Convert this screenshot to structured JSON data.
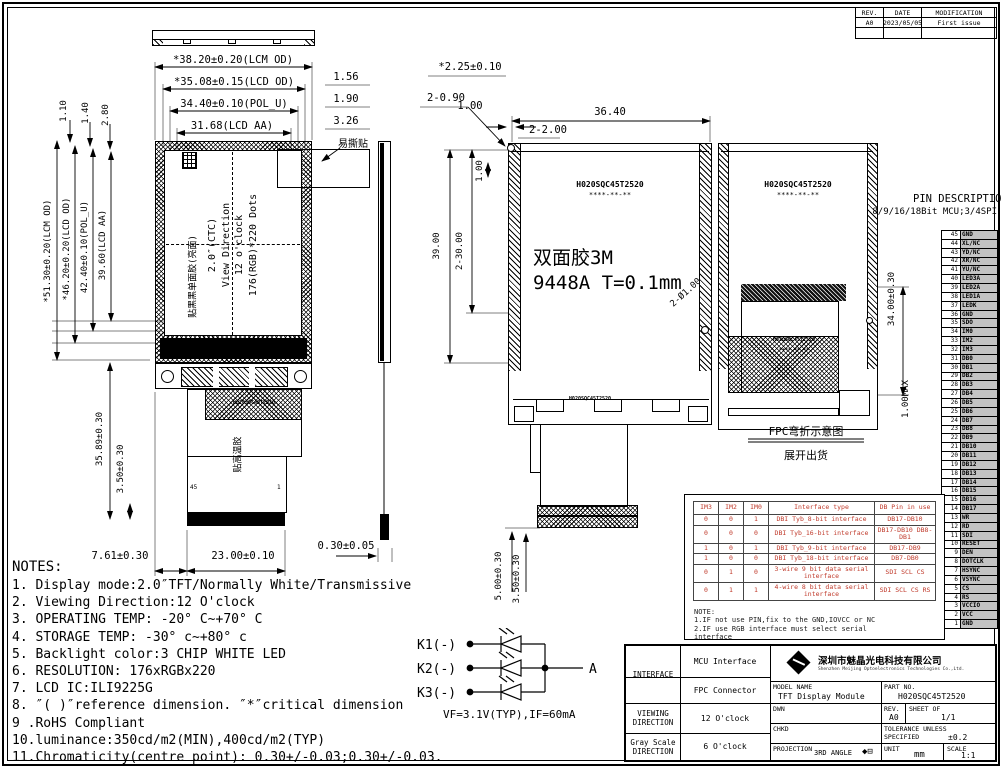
{
  "sheet": {
    "rev_header": "REV.",
    "date_header": "DATE",
    "mod_header": "MODIFICATION",
    "rev_value": "A0",
    "date_value": "2023/05/05",
    "mod_value": "First issue"
  },
  "left_view": {
    "dims": {
      "lcm_w": "*38.20±0.20(LCM OD)",
      "lcd_w": "*35.08±0.15(LCD OD)",
      "pol_w": "34.40±0.10(POL_U)",
      "aa_w": "31.68(LCD AA)",
      "off1": "1.56",
      "off2": "1.90",
      "off3": "3.26",
      "t1": "1.10",
      "t2": "1.40",
      "t3": "2.80",
      "lcm_h": "*51.30±0.20(LCM OD)",
      "lcd_h": "*46.20±0.20(LCD OD)",
      "pol_h": "42.40±0.10(POL_U)",
      "aa_h": "39.60(LCD AA)",
      "fpc_h": "35.89±0.30",
      "conn_h": "3.50±0.30",
      "fpc_x": "7.61±0.30",
      "conn_w": "23.00±0.10",
      "thick": "0.30±0.05"
    },
    "screen": {
      "line1": "2.0″(CTC)",
      "line2": "View Direction",
      "line3": "12 o'clock",
      "line4": "176(RGB)*220 Dots"
    },
    "labels": {
      "tear": "易撕贴",
      "black_tape": "贴黑黑单面胶(亮面)",
      "ht_tape": "贴高温胶"
    },
    "fpc_marking": "H020SQC45T2520",
    "pin_left": "45",
    "pin_right": "1"
  },
  "middle_view": {
    "dims": {
      "d1": "*2.25±0.10",
      "d2": "2-0.90",
      "d3": "1.00",
      "d4": "36.40",
      "d5": "2-2.00",
      "v1": "39.00",
      "v2": "2-30.00",
      "v3": "1.00",
      "hole": "2-Ø1.00",
      "b1": "5.00±0.30",
      "b2": "3.50±0.30"
    },
    "marking1": "H020SQC45T2520",
    "marking2": "****-**-**",
    "tape1": "双面胶3M",
    "tape2": "9448A T=0.1mm",
    "fpc_marking": "H020SQC45T2520"
  },
  "right_view": {
    "marking1": "H020SQC45T2520",
    "marking2": "****-**-**",
    "fpc_marking1": "H020SQC45T2520",
    "fpc_marking2": "****-**-**",
    "dims": {
      "h": "34.00±0.30",
      "max": "1.00MAX"
    },
    "caption1": "FPC弯折示意图",
    "caption2": "展开出货"
  },
  "pin_desc": {
    "title": "PIN DESCRIPTION",
    "subtitle": "8/9/16/18Bit MCU;3/4SPI",
    "pins": [
      {
        "n": "45",
        "v": "GND"
      },
      {
        "n": "44",
        "v": "XL/NC"
      },
      {
        "n": "43",
        "v": "YD/NC"
      },
      {
        "n": "42",
        "v": "XR/NC"
      },
      {
        "n": "41",
        "v": "YU/NC"
      },
      {
        "n": "40",
        "v": "LED3A"
      },
      {
        "n": "39",
        "v": "LED2A"
      },
      {
        "n": "38",
        "v": "LED1A"
      },
      {
        "n": "37",
        "v": "LEDK"
      },
      {
        "n": "36",
        "v": "GND"
      },
      {
        "n": "35",
        "v": "SDO"
      },
      {
        "n": "34",
        "v": "IM0"
      },
      {
        "n": "33",
        "v": "IM2"
      },
      {
        "n": "32",
        "v": "IM3"
      },
      {
        "n": "31",
        "v": "DB0"
      },
      {
        "n": "30",
        "v": "DB1"
      },
      {
        "n": "29",
        "v": "DB2"
      },
      {
        "n": "28",
        "v": "DB3"
      },
      {
        "n": "27",
        "v": "DB4"
      },
      {
        "n": "26",
        "v": "DB5"
      },
      {
        "n": "25",
        "v": "DB6"
      },
      {
        "n": "24",
        "v": "DB7"
      },
      {
        "n": "23",
        "v": "DB8"
      },
      {
        "n": "22",
        "v": "DB9"
      },
      {
        "n": "21",
        "v": "DB10"
      },
      {
        "n": "20",
        "v": "DB11"
      },
      {
        "n": "19",
        "v": "DB12"
      },
      {
        "n": "18",
        "v": "DB13"
      },
      {
        "n": "17",
        "v": "DB14"
      },
      {
        "n": "16",
        "v": "DB15"
      },
      {
        "n": "15",
        "v": "DB16"
      },
      {
        "n": "14",
        "v": "DB17"
      },
      {
        "n": "13",
        "v": "WR"
      },
      {
        "n": "12",
        "v": "RD"
      },
      {
        "n": "11",
        "v": "SDI"
      },
      {
        "n": "10",
        "v": "RESET"
      },
      {
        "n": "9",
        "v": "DEN"
      },
      {
        "n": "8",
        "v": "DOTCLK"
      },
      {
        "n": "7",
        "v": "HSYNC"
      },
      {
        "n": "6",
        "v": "VSYNC"
      },
      {
        "n": "5",
        "v": "CS"
      },
      {
        "n": "4",
        "v": "RS"
      },
      {
        "n": "3",
        "v": "VCCIO"
      },
      {
        "n": "2",
        "v": "VCC"
      },
      {
        "n": "1",
        "v": "GND"
      }
    ]
  },
  "interface_table": {
    "headers": {
      "im3": "IM3",
      "im2": "IM2",
      "im0": "IM0",
      "type": "Interface type",
      "db": "DB Pin in use"
    },
    "rows": [
      {
        "a": "0",
        "b": "0",
        "c": "1",
        "t": "DBI Tyb_8-bit interface",
        "d": "DB17-DB10"
      },
      {
        "a": "0",
        "b": "0",
        "c": "0",
        "t": "DBI Tyb_16-bit interface",
        "d": "DB17-DB10 DB8-DB1"
      },
      {
        "a": "1",
        "b": "0",
        "c": "1",
        "t": "DBI Tyb_9-bit interface",
        "d": "DB17-DB9"
      },
      {
        "a": "1",
        "b": "0",
        "c": "0",
        "t": "DBI Tyb_18-bit interface",
        "d": "DB7-DB0"
      },
      {
        "a": "0",
        "b": "1",
        "c": "0",
        "t": "3-wire 9 bit data serial interface",
        "d": "SDI SCL CS"
      },
      {
        "a": "0",
        "b": "1",
        "c": "1",
        "t": "4-wire 8 bit data serial interface",
        "d": "SDI SCL CS RS"
      }
    ],
    "note_title": "NOTE:",
    "notes": [
      {
        "t": "1.IF not use PIN,fix to the GND,IOVCC or NC"
      },
      {
        "t": "2.IF use RGB interface must select serial"
      },
      {
        "t": "interface"
      }
    ]
  },
  "notes": {
    "title": "NOTES:",
    "items": [
      {
        "t": "1. Display mode:2.0″TFT/Normally White/Transmissive"
      },
      {
        "t": "2. Viewing Direction:12 O'clock"
      },
      {
        "t": "3. OPERATING TEMP: -20° C~+70° C"
      },
      {
        "t": "4. STORAGE TEMP: -30° c~+80° c"
      },
      {
        "t": "5. Backlight color:3 CHIP WHITE LED"
      },
      {
        "t": "6. RESOLUTION: 176xRGBx220"
      },
      {
        "t": "7. LCD IC:ILI9225G"
      },
      {
        "t": "8. ″( )″reference dimension. ″*″critical dimension"
      },
      {
        "t": "9 .RoHS Compliant"
      },
      {
        "t": "10.luminance:350cd/m2(MIN),400cd/m2(TYP)"
      },
      {
        "t": "11.Chromaticity(centre point): 0.30+/-0.03;0.30+/-0.03."
      }
    ]
  },
  "led_circuit": {
    "k1": "K1(-)",
    "k2": "K2(-)",
    "k3": "K3(-)",
    "anode": "A",
    "spec": "VF=3.1V(TYP),IF=60mA"
  },
  "title_block": {
    "interface_label": "INTERFACE",
    "interface_row1": "MCU Interface",
    "interface_row2": "FPC Connector",
    "viewing_label1": "VIEWING",
    "viewing_label2": "DIRECTION",
    "viewing_value": "12 O'clock",
    "gray_label1": "Gray Scale",
    "gray_label2": "DIRECTION",
    "gray_value": "6 O'clock",
    "company_cn": "深圳市魅晶光电科技有限公司",
    "company_en": "Shenzhen Meijing Optoelectronics Technologies Co.,Ltd.",
    "model_label": "MODEL NAME",
    "model_value": "TFT Display Module",
    "part_label": "PART NO.",
    "part_value": "H020SQC45T2520",
    "dwn_label": "DWN",
    "chkd_label": "CHKD",
    "projection_label": "PROJECTION",
    "projection_value": "3RD ANGLE",
    "projection_symbol": "◆⊟",
    "rev_label": "REV.",
    "rev_value": "A0",
    "sheet_label": "SHEET OF",
    "sheet_value": "1/1",
    "tol_label1": "TOLERANCE UNLESS",
    "tol_label2": "SPECIFIED",
    "tol_value": "±0.2",
    "unit_label": "UNIT",
    "unit_value": "mm",
    "scale_label": "SCALE",
    "scale_value": "1:1"
  }
}
